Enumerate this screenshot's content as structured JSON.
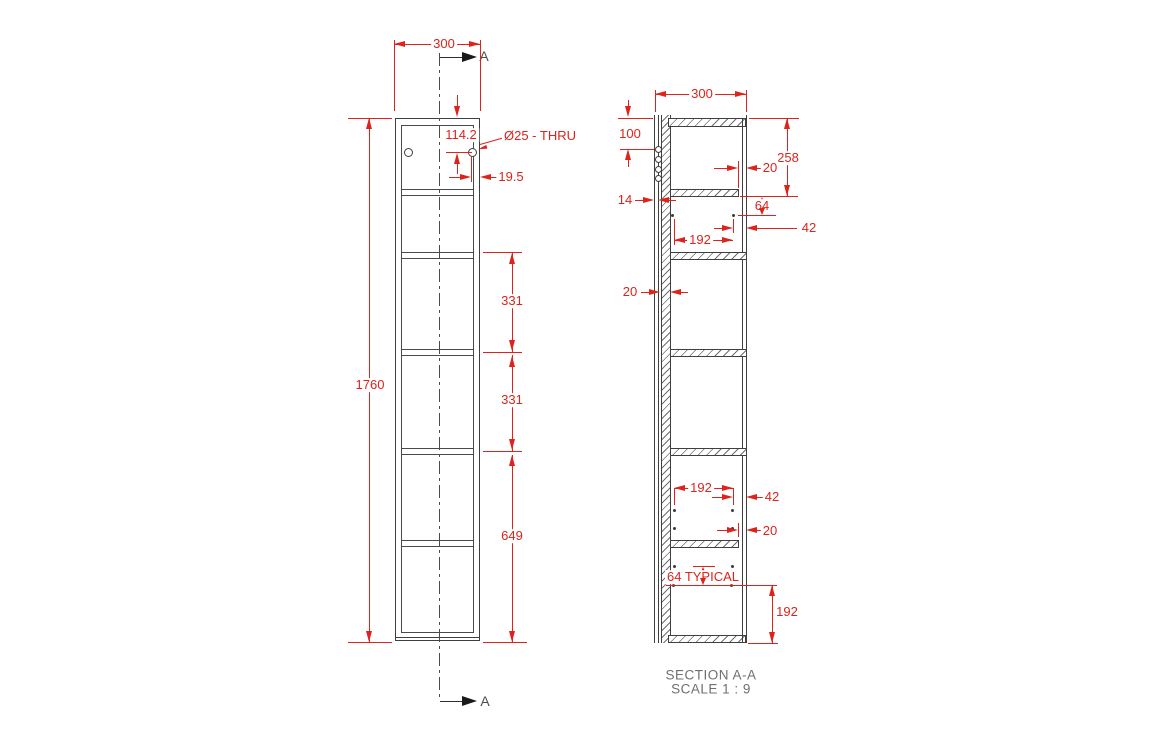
{
  "colors": {
    "dimension_red": "#dd231b",
    "geometry_gray": "#3f3f3f",
    "caption_gray": "#6f6f6f"
  },
  "front_view": {
    "width": "300",
    "height": "1760",
    "hole_offset_from_top": "114.2",
    "hole_callout": "Ø25 - THRU",
    "hole_offset_from_side": "19.5",
    "shelf_spacing_1": "331",
    "shelf_spacing_2": "331",
    "bottom_section": "649",
    "section_label_top": "A",
    "section_label_bottom": "A"
  },
  "section_view": {
    "width": "300",
    "hole_line_from_top": "100",
    "back_sheet_thickness": "14",
    "back_panel_thickness": "20",
    "top_to_first_shelf": "258",
    "shelf_to_pin_row": "64",
    "pin_spacing_upper": "192",
    "pin_to_front_upper": "42",
    "shelf_setback_upper": "20",
    "pin_spacing_lower": "192",
    "pin_to_front_lower": "42",
    "shelf_setback_lower": "20",
    "pin_pitch_note": "64 TYPICAL",
    "pin_to_bottom": "192"
  },
  "caption": {
    "line1": "SECTION A-A",
    "line2": "SCALE 1 : 9"
  }
}
